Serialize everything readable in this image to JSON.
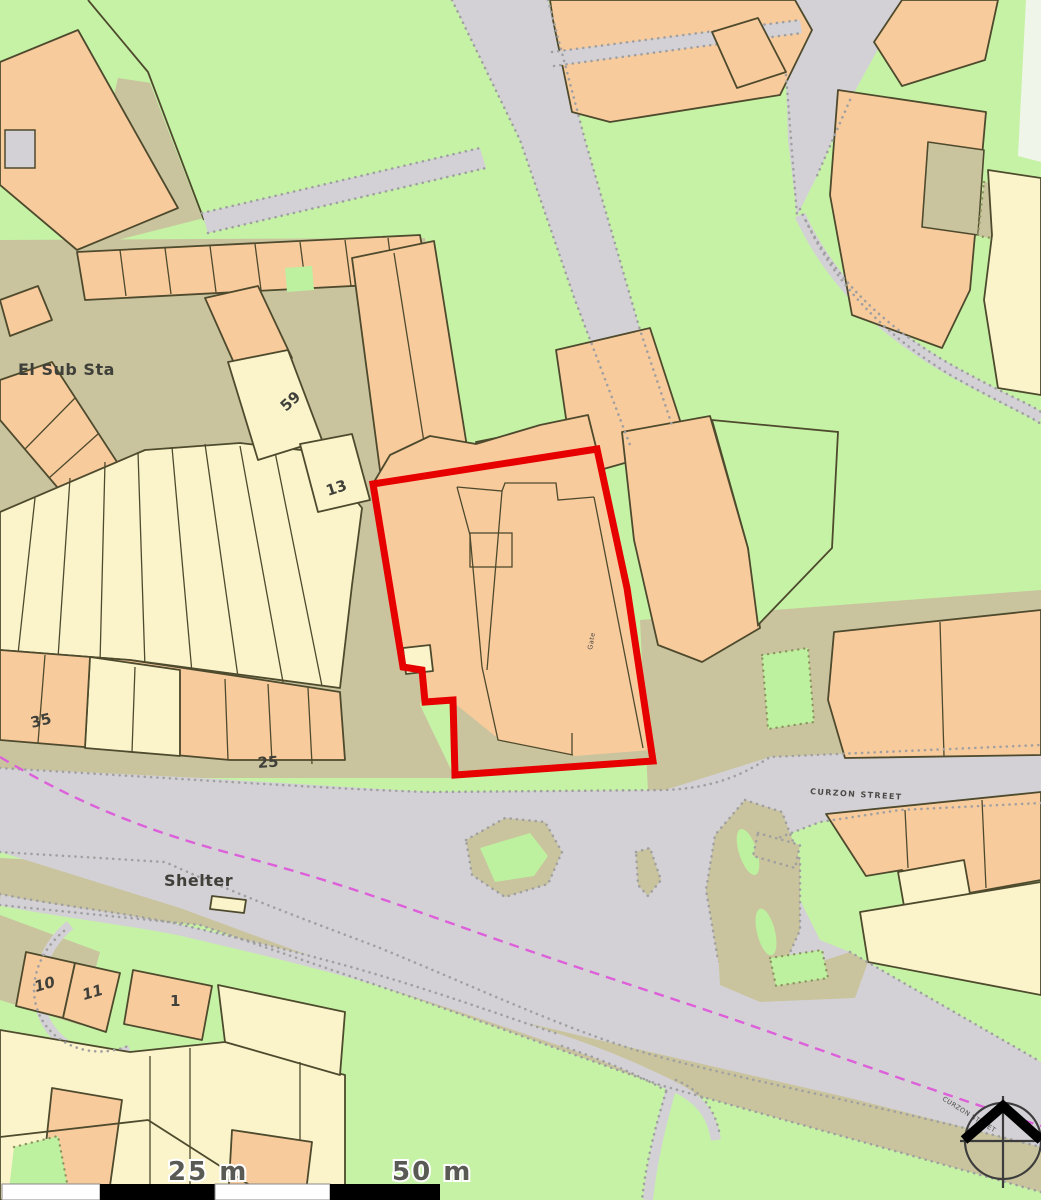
{
  "map": {
    "labels": {
      "el_sub_sta": "El Sub Sta",
      "no59": "59",
      "no13": "13",
      "no35": "35",
      "no25": "25",
      "no10": "10",
      "no11": "11",
      "no1": "1",
      "shelter": "Shelter",
      "street": "CURZON STREET",
      "street_small": "CURZON STREET",
      "plot_note": "Gate"
    },
    "scale": {
      "mid": "25 m",
      "end": "50 m"
    },
    "colors": {
      "grass": "#c6f2a6",
      "khaki": "#c9c49e",
      "road": "#d3d1d6",
      "building-orange": "#f8cb9d",
      "building-cream": "#fbf4cb",
      "outline": "#4e4a2d",
      "plot-red": "#e60000",
      "boundary-magenta": "#dd5fd9",
      "dot": "#a0a0a0",
      "label": "#40403a"
    }
  }
}
